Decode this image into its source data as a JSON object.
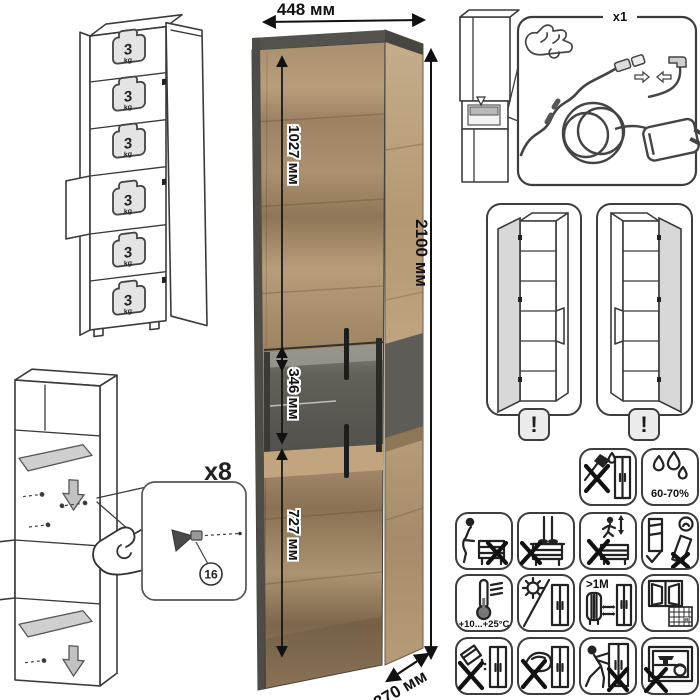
{
  "main_dimensions": {
    "width_label": "448 мм",
    "height_label": "2100 мм",
    "depth_label": "370 мм",
    "top_section_label": "1027 мм",
    "middle_section_label": "346 мм",
    "bottom_section_label": "727 мм"
  },
  "load_diagram": {
    "shelf_load_value": "3",
    "shelf_load_unit": "kg",
    "shelf_count": 6
  },
  "assembly_detail": {
    "fastener_count_label": "x8",
    "part_number": "16"
  },
  "led_kit": {
    "count_label": "x1"
  },
  "door_variants": {
    "left_warning_mark": "!",
    "right_warning_mark": "!"
  },
  "care": {
    "humidity_label": "60-70%",
    "temperature_label": "+10...+25°C",
    "heat_distance_label": ">1М",
    "calendar_day": "21"
  },
  "icon_names": [
    "no-sharp-tools-icon",
    "humidity-60-70-icon",
    "no-sitting-icon",
    "no-standing-icon",
    "no-jumping-icon",
    "carry-upright-icon",
    "temperature-range-icon",
    "no-direct-sunlight-icon",
    "keep-distance-from-heat-icon",
    "ventilate-room-icon",
    "no-abrasive-cleaners-icon",
    "no-wet-cloth-icon",
    "no-dragging-icon",
    "no-heavy-objects-icon"
  ],
  "colors": {
    "wood_light": "#b49a77",
    "wood_dark": "#8f7658",
    "frame_dark": "#4e4c47",
    "niche_dark": "#54534e"
  }
}
